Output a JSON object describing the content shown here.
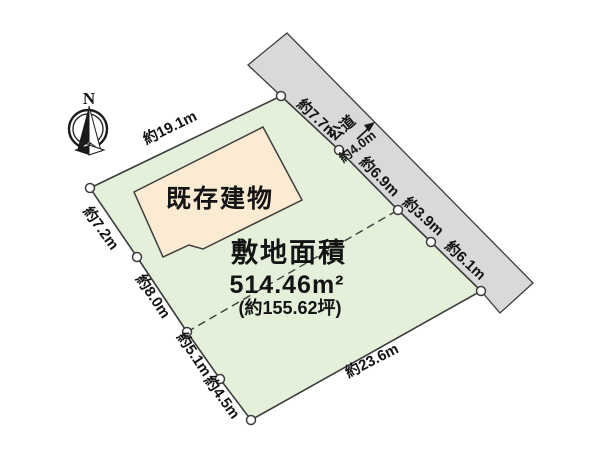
{
  "compass": {
    "north_label": "N"
  },
  "parcel": {
    "area_title": "敷地面積",
    "area_value": "514.46m²",
    "area_tsubo": "(約155.62坪)",
    "building_label": "既存建物"
  },
  "road": {
    "label": "公道",
    "width_label": "約4.0m"
  },
  "dimensions": {
    "top": "約19.1m",
    "left_upper": "約7.2m",
    "left_lower": "約8.0m",
    "bottom_left_upper": "約5.1m",
    "bottom_left_lower": "約4.5m",
    "bottom": "約23.6m",
    "road_upper": "約7.7m",
    "road_mid": "約6.9m",
    "road_lower": "約3.9m",
    "road_bottom": "約6.1m"
  },
  "colors": {
    "parcel_fill": "#e4f0da",
    "building_fill": "#fbebd3",
    "road_fill": "#d9d9d9",
    "outline": "#3d3d3d"
  }
}
